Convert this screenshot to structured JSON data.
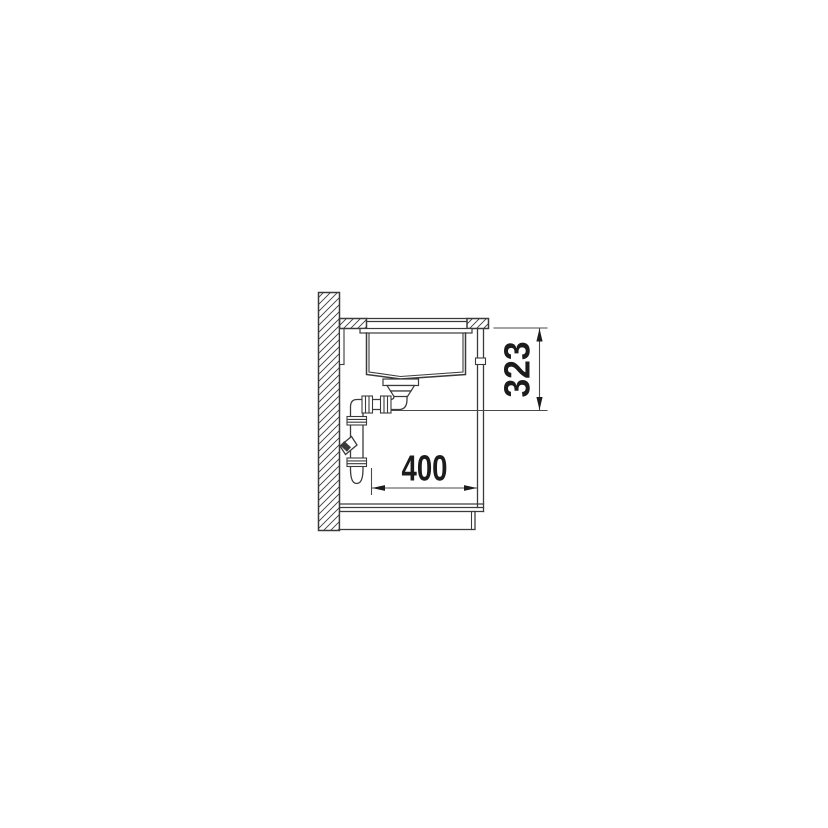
{
  "page": {
    "background_color": "#ffffff"
  },
  "drawing": {
    "kind": "technical-installation-drawing",
    "subject": "undermount-sink-cabinet-side-section",
    "line_color": "#3a3a3a",
    "dim_line_color": "#4a4a4a",
    "dim_text_color": "#1c1c1c",
    "hatch_style": "diagonal",
    "dimensions": {
      "vertical": {
        "value": "323",
        "orientation": "vertical",
        "unit": "mm"
      },
      "horizontal": {
        "value": "400",
        "orientation": "horizontal",
        "unit": "mm"
      }
    },
    "parts": [
      {
        "name": "wall"
      },
      {
        "name": "worktop"
      },
      {
        "name": "mounting-rail"
      },
      {
        "name": "sink-rim"
      },
      {
        "name": "sink-bowl"
      },
      {
        "name": "drain-strainer"
      },
      {
        "name": "siphon-trap"
      },
      {
        "name": "wall-outlet-branch"
      },
      {
        "name": "cabinet-side-panel"
      },
      {
        "name": "cabinet-floor"
      },
      {
        "name": "plinth"
      }
    ]
  }
}
